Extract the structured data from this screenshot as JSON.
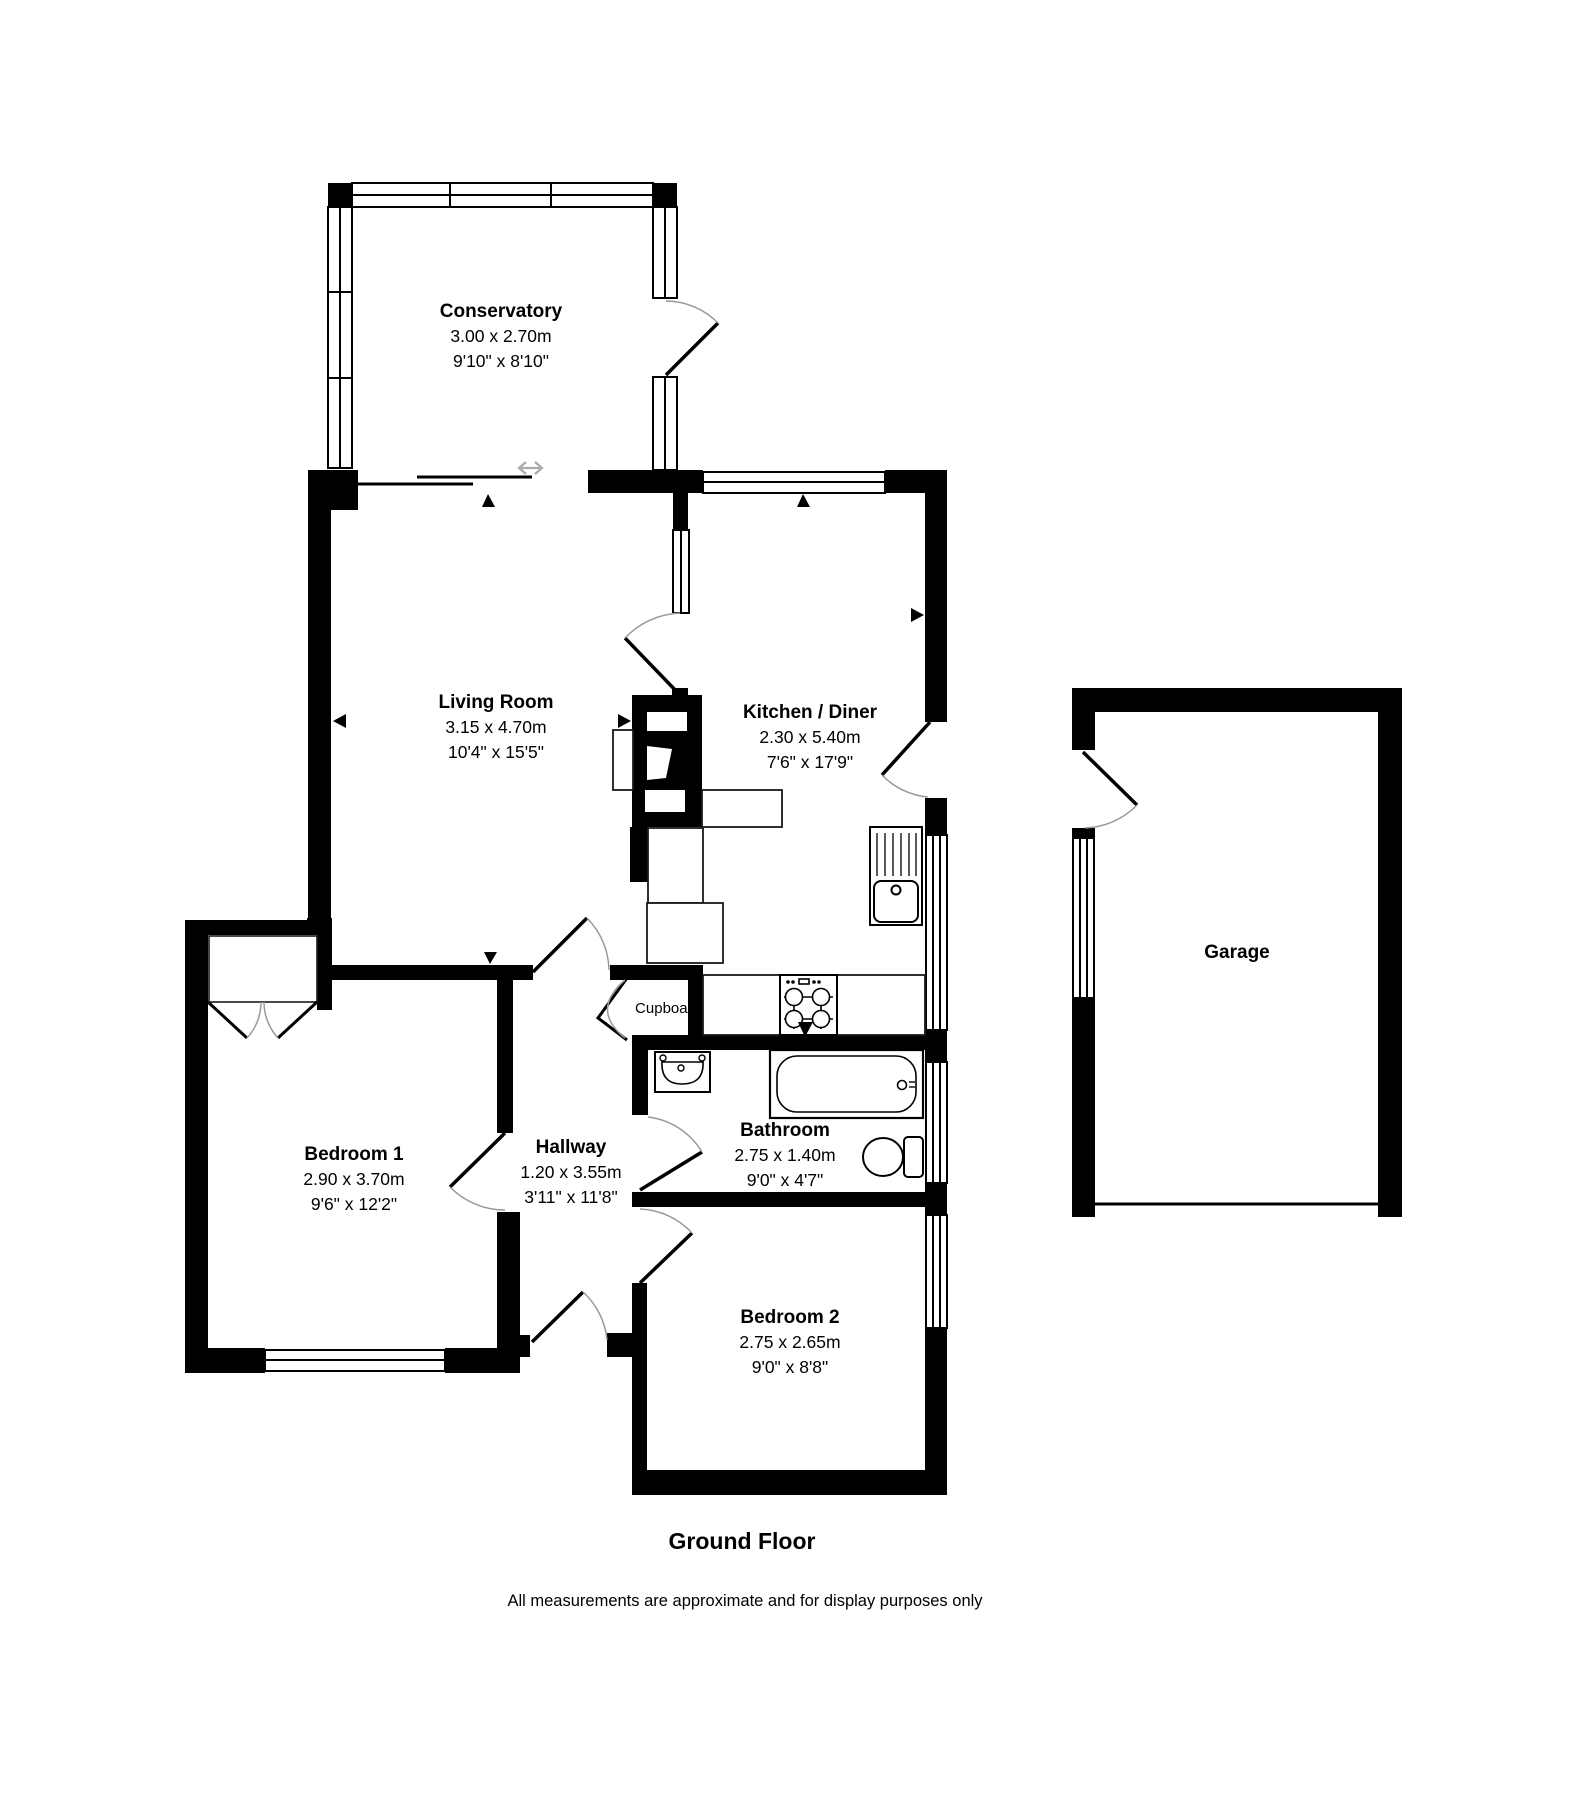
{
  "plan": {
    "title": "Ground Floor",
    "disclaimer": "All measurements are approximate and for display purposes only",
    "colors": {
      "wall": "#000000",
      "background": "#ffffff",
      "door_arc": "#999999"
    }
  },
  "rooms": {
    "conservatory": {
      "name": "Conservatory",
      "metric": "3.00 x 2.70m",
      "imperial": "9'10\" x 8'10\""
    },
    "living_room": {
      "name": "Living Room",
      "metric": "3.15 x 4.70m",
      "imperial": "10'4\" x 15'5\""
    },
    "kitchen_diner": {
      "name": "Kitchen / Diner",
      "metric": "2.30 x 5.40m",
      "imperial": "7'6\" x 17'9\""
    },
    "garage": {
      "name": "Garage"
    },
    "bedroom_1": {
      "name": "Bedroom 1",
      "metric": "2.90 x 3.70m",
      "imperial": "9'6\" x 12'2\""
    },
    "hallway": {
      "name": "Hallway",
      "metric": "1.20 x 3.55m",
      "imperial": "3'11\" x 11'8\""
    },
    "bathroom": {
      "name": "Bathroom",
      "metric": "2.75 x 1.40m",
      "imperial": "9'0\" x 4'7\""
    },
    "bedroom_2": {
      "name": "Bedroom 2",
      "metric": "2.75 x 2.65m",
      "imperial": "9'0\" x 8'8\""
    },
    "cupboard": {
      "name": "Cupboard"
    }
  }
}
